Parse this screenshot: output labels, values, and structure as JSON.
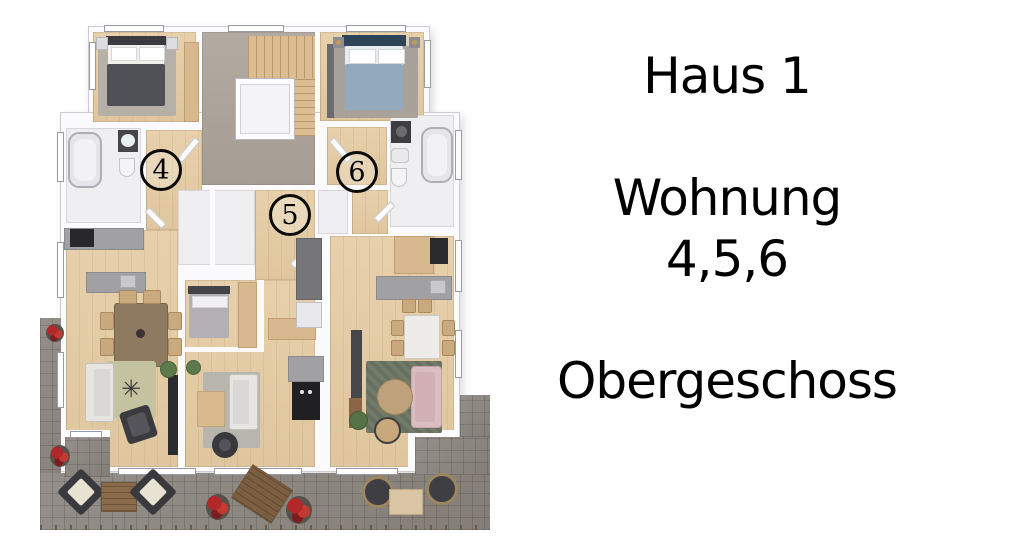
{
  "label_panel": {
    "title": "Haus 1",
    "subtitle": "Wohnung",
    "unit_numbers": "4,5,6",
    "floor_label": "Obergeschoss"
  },
  "floorplan": {
    "units": [
      {
        "number": "4"
      },
      {
        "number": "5"
      },
      {
        "number": "6"
      }
    ],
    "rug_star_icon": "✳"
  },
  "palette": {
    "wood_floor": "#e4cda8",
    "terrace_paving": "#8f8a85",
    "stairwell_floor": "#aba39b",
    "wall": "#fbfbfd",
    "flower_red": "#b3262a",
    "bed_blue": "#92aabc",
    "sofa_pink": "#dabdc0",
    "rug_olive": "#c5c2a0",
    "rug_green": "#67705e",
    "text": "#000000"
  }
}
